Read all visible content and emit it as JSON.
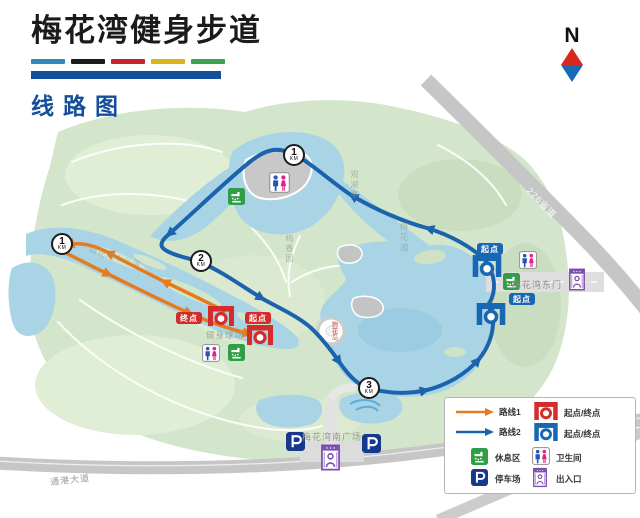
{
  "header": {
    "title": "梅花湾健身步道",
    "subtitle": "线路图"
  },
  "compass": {
    "north": "N"
  },
  "map": {
    "km_unit": "KM",
    "markers": {
      "west1": "1",
      "top1": "1",
      "mid2": "2",
      "south3": "3"
    },
    "badges": {
      "start": "起点",
      "end": "终点"
    },
    "labels": {
      "east_gate": "梅花湾东门",
      "south_plaza": "梅花湾南广场",
      "provincial_road": "226省道",
      "bottom_road": "通港大道",
      "fitness_court": "健身球场",
      "water_channel": "梅花湾十八湾",
      "lake": "梅花湖",
      "garden": "梅香园",
      "pavilion": "观湖亭",
      "island": "梅花岛"
    }
  },
  "legend": {
    "items": [
      {
        "label": "路线1"
      },
      {
        "label": "路线2"
      },
      {
        "label": "起点/终点"
      },
      {
        "label": "起点/终点"
      },
      {
        "label": "休息区"
      },
      {
        "label": "卫生间"
      },
      {
        "label": "停车场"
      },
      {
        "label": "出入口"
      }
    ]
  },
  "colors": {
    "route1": "#e87a1e",
    "route2": "#1b63ad",
    "water": "#a9d4e6",
    "park": "#d3e5ca",
    "road": "#c6c6c6",
    "red_marker": "#d42b2b",
    "blue_marker": "#1767b3",
    "rest_green": "#2f9e45",
    "parking_blue": "#16388f",
    "entrance_purple": "#7d4fae",
    "title_blue": "#134f9a",
    "bar_colors": [
      "#3388bb",
      "#1b1b1b",
      "#c3242b",
      "#d8b51f",
      "#3fa14b"
    ]
  }
}
